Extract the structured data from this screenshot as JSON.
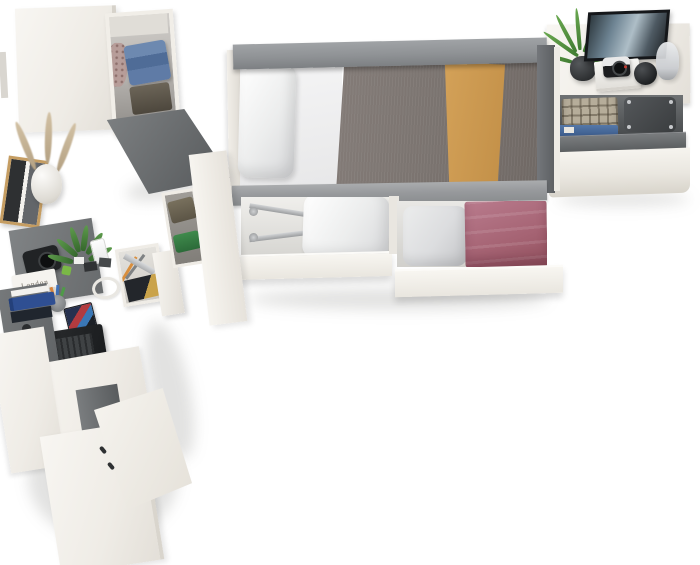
{
  "scene": {
    "type": "furniture-product-render",
    "view": "top-down",
    "background": "#ffffff",
    "description": "Top-down 3D render of a youth bedroom furniture set: wardrobe-and-desk unit on the left, a single bed with two open under-bed drawers in the center, and a white chest / nightstand with an open drawer on the right."
  },
  "palette": {
    "furniture_white": "#f4f2ed",
    "panel_gray": "#6e7173",
    "rail_gray": "#929497",
    "duvet_gray": "#7b7470",
    "blanket_mustard": "#cc9851",
    "blanket_plum": "#ad6b7d",
    "denim_blue": "#5b77a3",
    "plant_green": "#4e8a41",
    "interior_gray": "#c9c7c3"
  },
  "units": {
    "wardrobe_desk_unit": {
      "name": "wardrobe and desk combination (left)",
      "props": [
        "open wardrobe compartment with folded jeans and dark clothes",
        "patterned garment",
        "open gray wardrobe door",
        "wood picture frame with photo collage",
        "white vase with pampas grass",
        "gray desk return shelf",
        "black camera",
        "white magazine",
        "potted green plant",
        "smartphone",
        "memory cards",
        "green chip",
        "coiled white cable",
        "pen cup with colored pens",
        "cd case",
        "dark laptop with backlit keyboard strip",
        "gray shelf unit with blue binders and action figure",
        "open stationery drawer with pencils, ruler and magazine",
        "clothes niche with olive and green garments",
        "lower white cabinet with open door and gray interior"
      ]
    },
    "bed_unit": {
      "name": "single bed with under-bed storage (center)",
      "props": [
        "gray head and foot rails",
        "white pillow",
        "white fitted sheet",
        "gray duvet",
        "mustard throw blanket",
        "open under-bed drawer with metal legs and white pillow",
        "open under-bed drawer with gray pillow and folded plum blanket"
      ]
    },
    "nightstand_unit": {
      "name": "white chest / nightstand (right)",
      "props": [
        "fern plant in dark pot",
        "black framed artwork",
        "white book with vintage camera on top",
        "round black speaker",
        "glass table lamp",
        "open drawer with plaid shirt, jeans and dark gray case",
        "dark gray drawer front"
      ]
    }
  },
  "labels": {
    "magazine_title": "London"
  }
}
